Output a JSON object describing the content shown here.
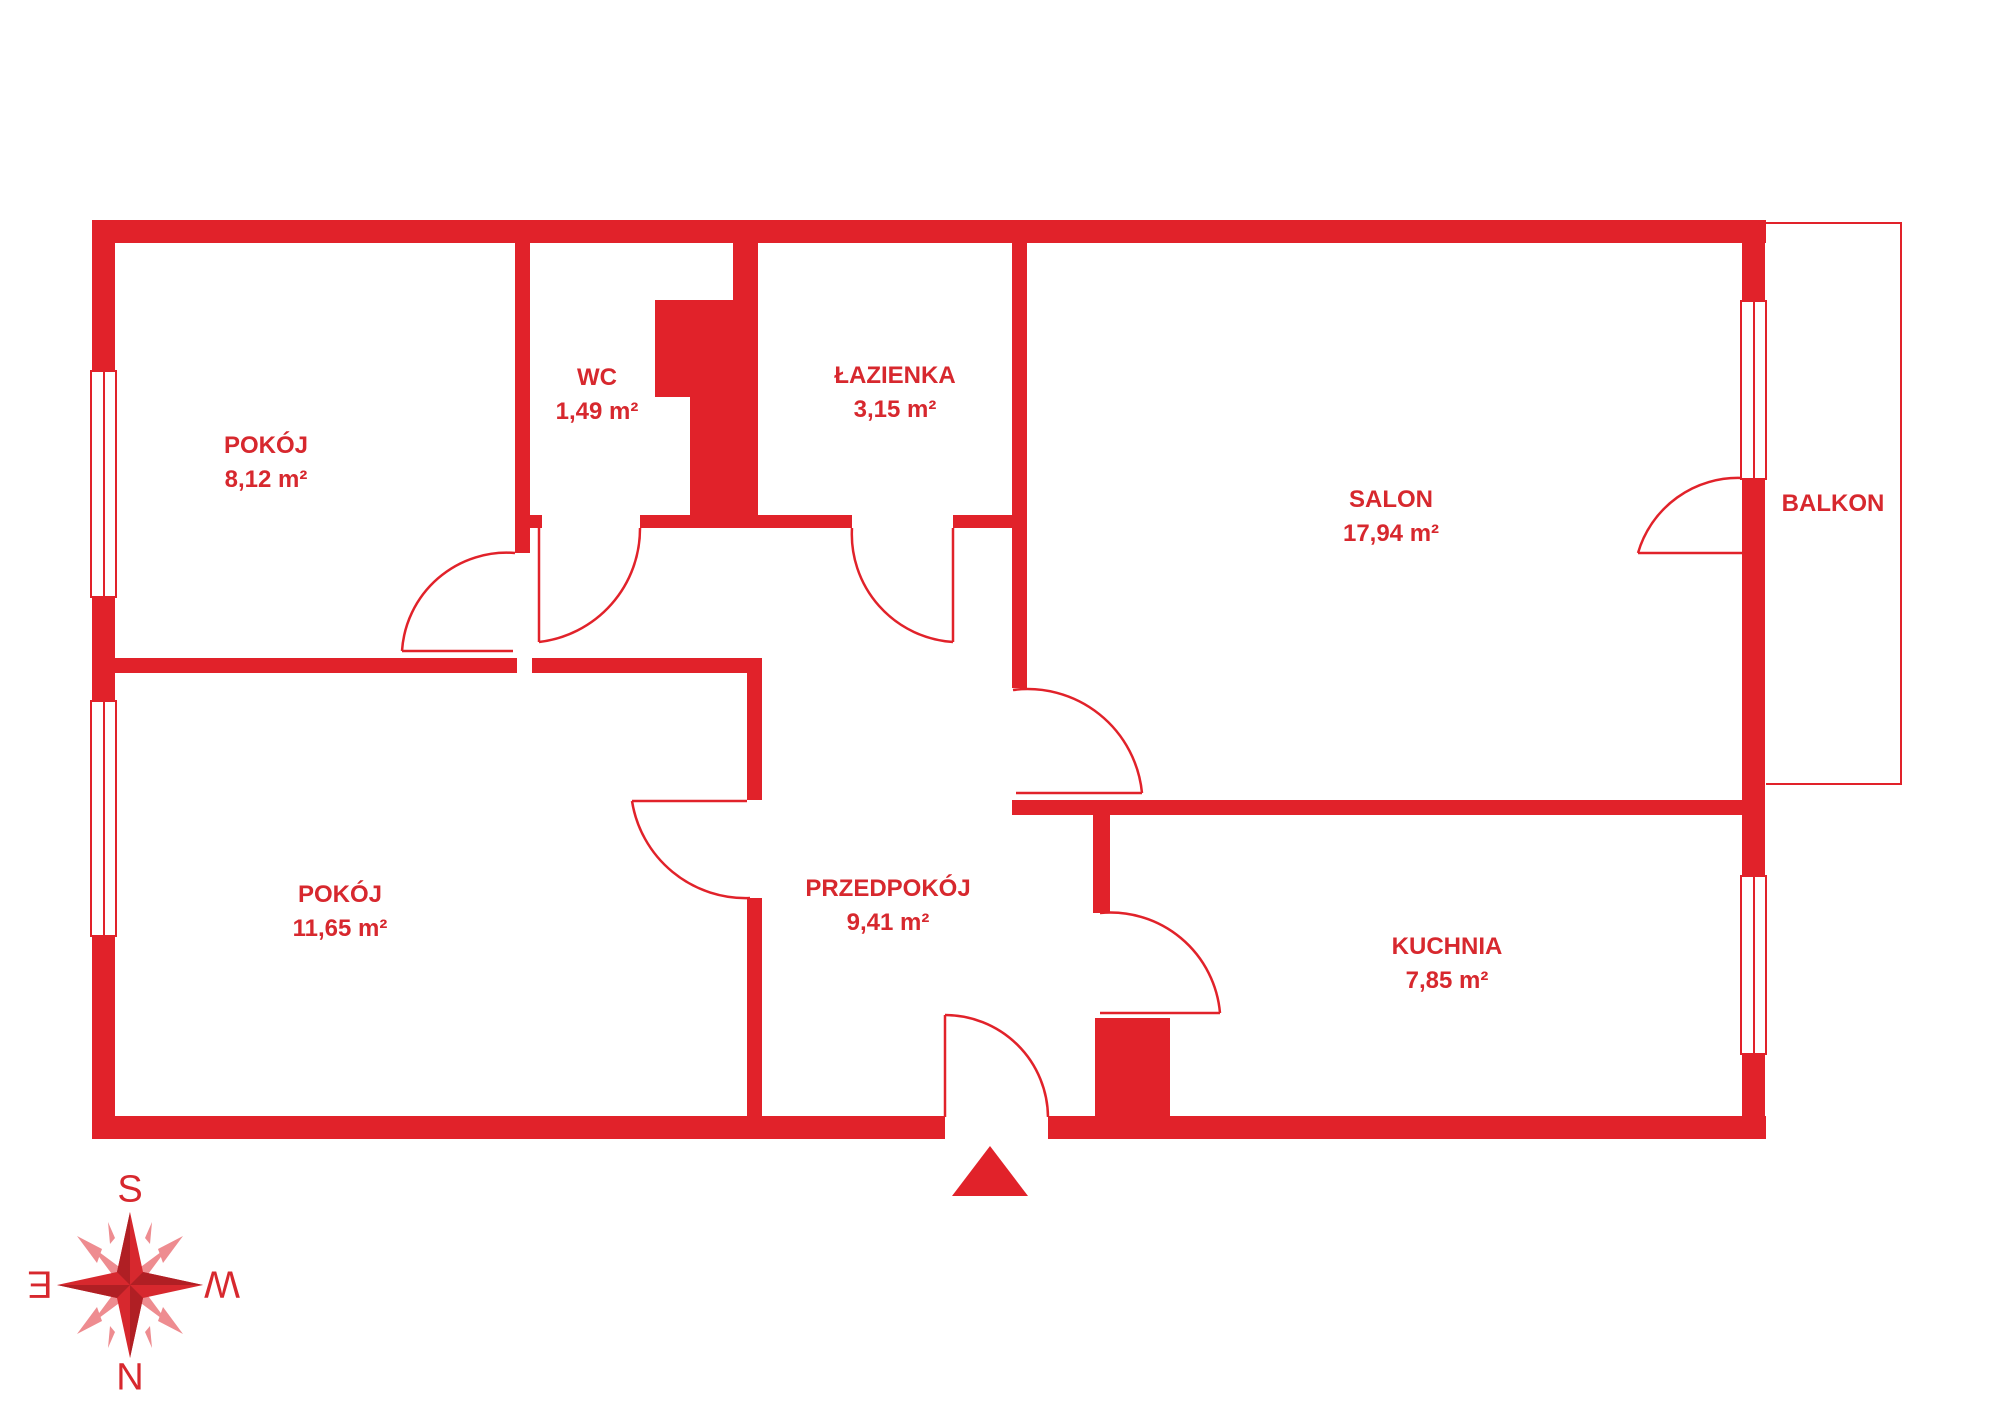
{
  "plan": {
    "rooms": [
      {
        "id": "pokoj-upper",
        "name": "POKÓJ",
        "area": "8,12 m²"
      },
      {
        "id": "wc",
        "name": "WC",
        "area": "1,49 m²"
      },
      {
        "id": "lazienka",
        "name": "ŁAZIENKA",
        "area": "3,15 m²"
      },
      {
        "id": "salon",
        "name": "SALON",
        "area": "17,94 m²"
      },
      {
        "id": "balkon",
        "name": "BALKON",
        "area": ""
      },
      {
        "id": "pokoj-lower",
        "name": "POKÓJ",
        "area": "11,65 m²"
      },
      {
        "id": "przedpokoj",
        "name": "PRZEDPOKÓJ",
        "area": "9,41 m²"
      },
      {
        "id": "kuchnia",
        "name": "KUCHNIA",
        "area": "7,85 m²"
      }
    ],
    "compass": {
      "top": "S",
      "right": "W",
      "bottom": "N",
      "left": "E"
    },
    "colors": {
      "wall_red": "#e1222a",
      "text_red": "#d7282e",
      "light_red": "#ee8c90"
    }
  }
}
